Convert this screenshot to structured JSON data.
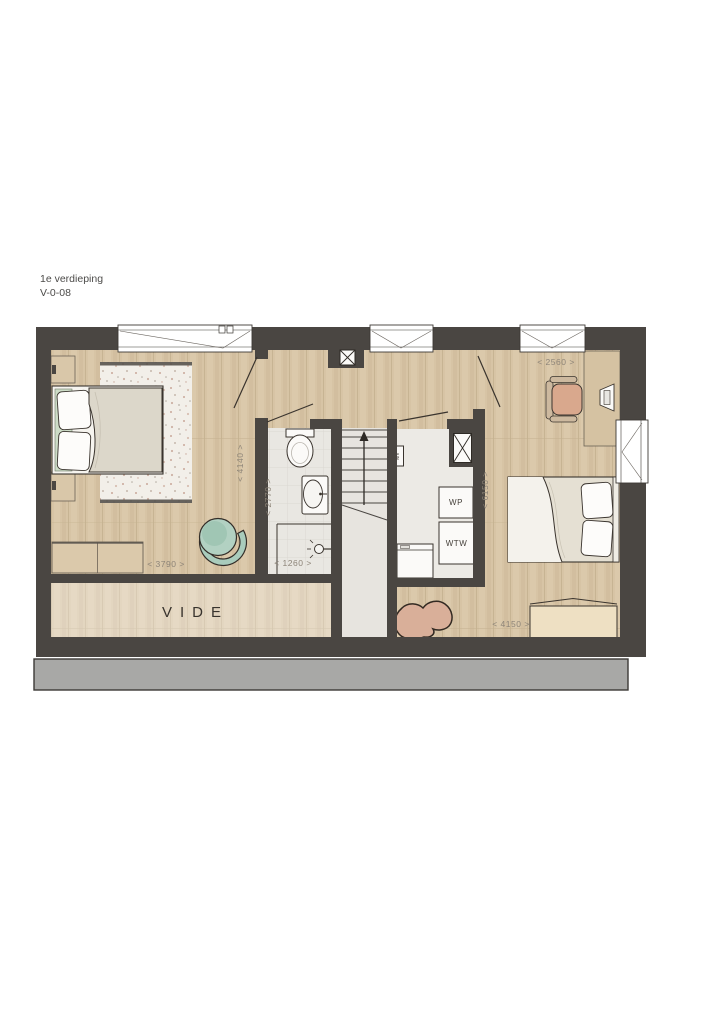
{
  "title": {
    "line1": "1e verdieping",
    "line2": "V-0-08"
  },
  "rooms": {
    "vide_label": "VIDE"
  },
  "tech": {
    "wp": "WP",
    "wtw": "WTW",
    "mv": "MV"
  },
  "dims": {
    "d3790": "< 3790 >",
    "d4140": "< 4140 >",
    "d2770": "< 2770 >",
    "d1260": "< 1260 >",
    "d2560": "< 2560 >",
    "d6150": "< 6150 >",
    "d4150": "< 4150 >"
  },
  "colors": {
    "wall": "#4a4642",
    "wood_floor": "#d7c4a5",
    "bathroom_floor": "#e9e7e2",
    "stair_void": "#e7e4df",
    "tech_floor": "#eceae5",
    "accent_teal": "#aecfc0",
    "accent_salmon": "#d9a88d",
    "furniture_tan": "#dbc9ab",
    "roof_band_gray": "#a8a8a6"
  }
}
